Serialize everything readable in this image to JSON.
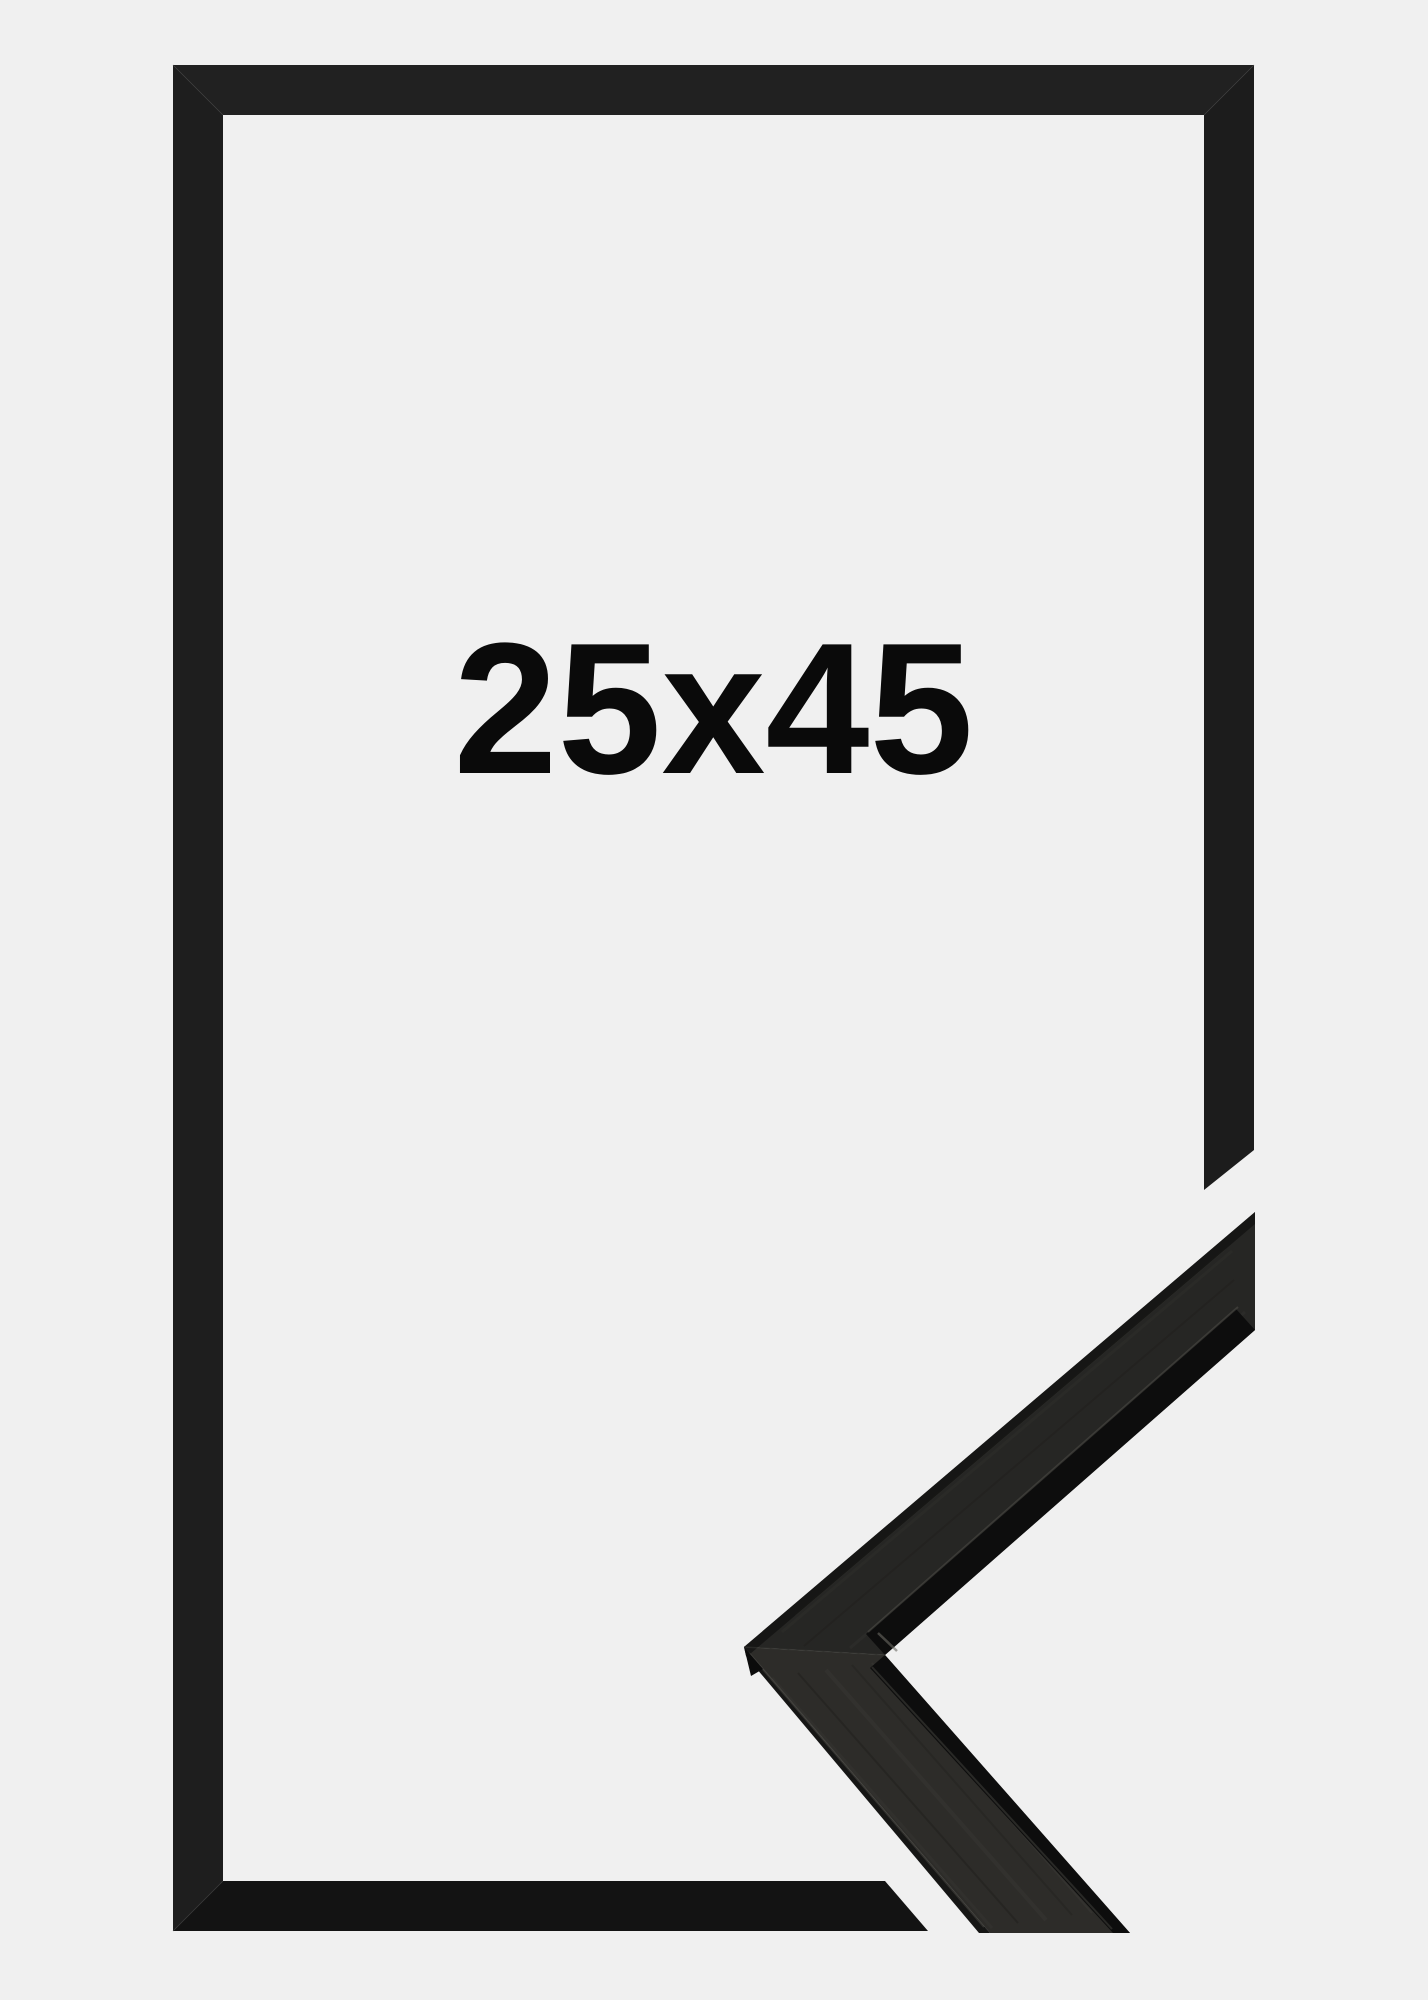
{
  "image": {
    "kind": "product-photo",
    "subject": "black picture frame with corner profile detail",
    "size_label": "25x45"
  },
  "colors": {
    "background": "#f0f0f0",
    "text": "#0a0a0a",
    "frame_top": "#212121",
    "frame_left": "#1e1e1e",
    "frame_right": "#1c1c1c",
    "frame_bottom": "#131313",
    "seam": "#3c3c3c",
    "sample_upper_face": "#262624",
    "sample_lower_face": "#2d2c29",
    "sample_lip": "#0d0d0d",
    "sample_side": "#161615",
    "sample_edge_dark": "#141413",
    "sample_highlight": "#54534d",
    "sample_seam": "#3a3a36",
    "sample_tip_facet": "#0b0b0b"
  }
}
